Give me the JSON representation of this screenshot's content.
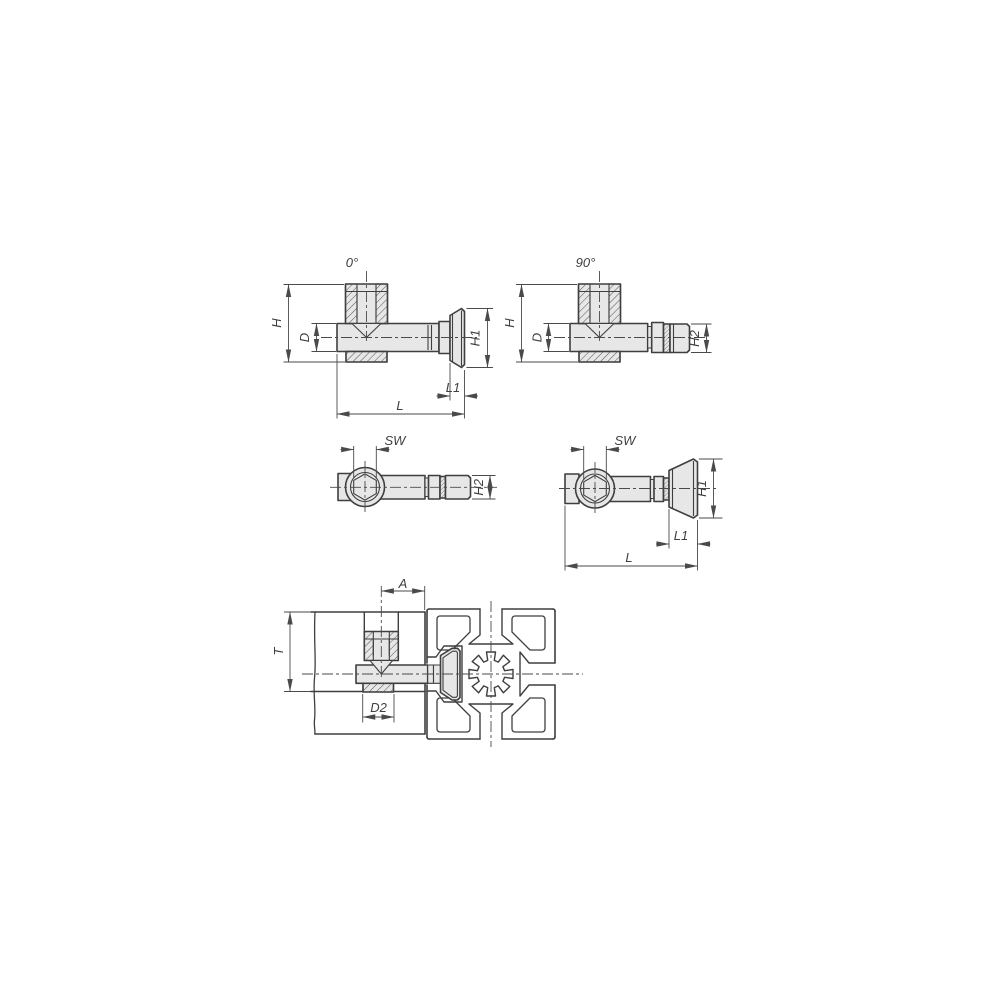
{
  "drawing": {
    "description": "Technical drawing of T-slot quick clamping fastener with five views",
    "views": {
      "side_0": {
        "title": "0°",
        "dim_height": "H",
        "dim_diameter": "D",
        "dim_head_height": "H1",
        "dim_head_length": "L1",
        "dim_length": "L"
      },
      "side_90": {
        "title": "90°",
        "dim_height": "H",
        "dim_diameter": "D",
        "dim_head_width": "H2"
      },
      "top_a": {
        "dim_hex": "SW",
        "dim_head_width": "H2"
      },
      "top_b": {
        "dim_hex": "SW",
        "dim_head_height": "H1",
        "dim_head_length": "L1",
        "dim_length": "L"
      },
      "assembly": {
        "dim_offset": "A",
        "dim_thickness": "T",
        "dim_counterbore": "D2"
      }
    },
    "colors": {
      "line": "#3f3f3f",
      "dim_line": "#4a4a4a",
      "part_fill": "#e7e7e7",
      "background": "#ffffff"
    }
  }
}
